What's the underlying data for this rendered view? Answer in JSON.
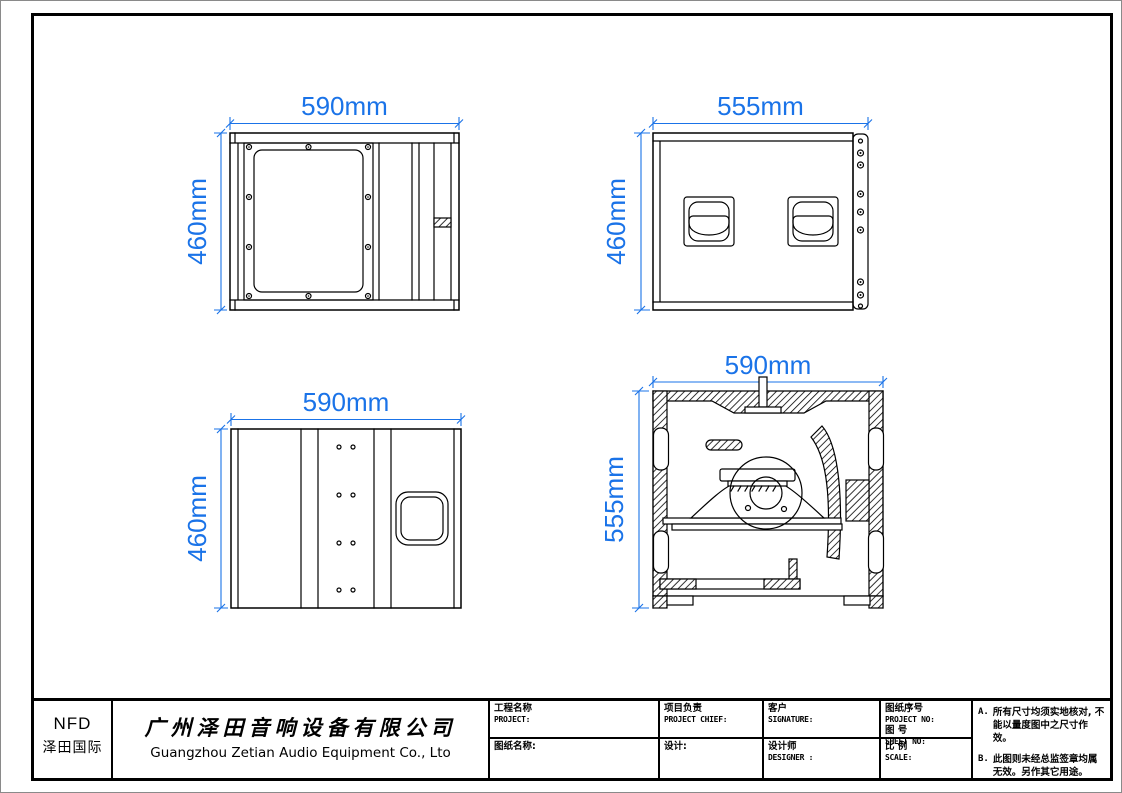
{
  "drawing": {
    "dimension_color": "#1a73e8",
    "views": {
      "rear": {
        "width_label": "590mm",
        "height_label": "460mm"
      },
      "front": {
        "width_label": "555mm",
        "height_label": "460mm"
      },
      "side": {
        "width_label": "590mm",
        "height_label": "460mm"
      },
      "section": {
        "width_label": "590mm",
        "height_label": "555mm"
      }
    }
  },
  "title_block": {
    "logo": {
      "brand": "NFD",
      "subtitle": "泽田国际"
    },
    "company": {
      "name_cn": "广州泽田音响设备有限公司",
      "name_en": "Guangzhou Zetian Audio Equipment Co., Lto"
    },
    "fields": {
      "project": {
        "cn": "工程名称",
        "en": "PROJECT:"
      },
      "drawing_name": {
        "cn": "图纸名称:"
      },
      "project_chief": {
        "cn": "项目负责",
        "en": "PROJECT CHIEF:"
      },
      "design": {
        "cn": "设计:"
      },
      "client": {
        "cn": "客户",
        "en": "SIGNATURE:"
      },
      "designer": {
        "cn": "设计师",
        "en": "DESIGNER :"
      },
      "project_no": {
        "cn": "图纸序号",
        "en": "PROJECT NO:"
      },
      "sheet_no": {
        "cn": "图 号",
        "en": "SHEET NO:"
      },
      "scale": {
        "cn": "比 例",
        "en": "SCALE:"
      }
    },
    "notes": {
      "a_label": "A.",
      "a_text": "所有尺寸均须实地核对, 不能以量度图中之尺寸作效。",
      "b_label": "B.",
      "b_text": "此图则未经总监签章均属无效。另作其它用途。"
    }
  }
}
